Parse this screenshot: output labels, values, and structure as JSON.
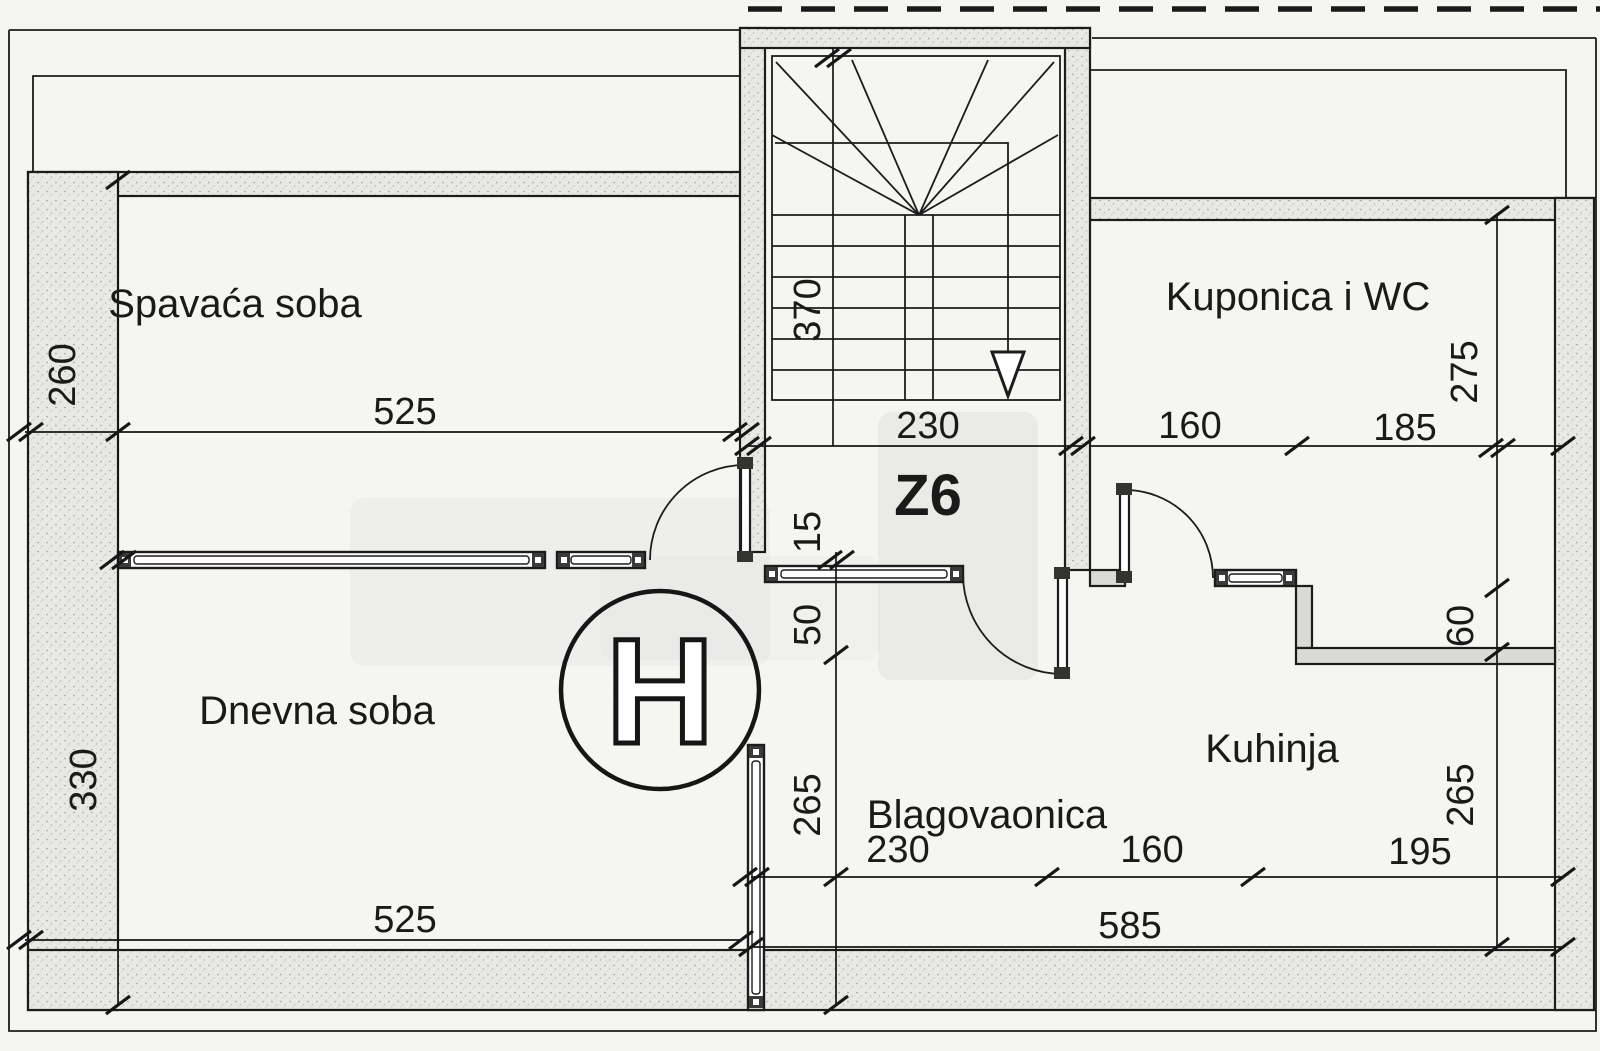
{
  "drawing": {
    "type": "apartment floor plan",
    "colors": {
      "ink": "#1a1a1a",
      "paper": "#f5f5f2",
      "wall_fill": "#e8e8e4"
    }
  },
  "rooms": {
    "bedroom": "Spavaća soba",
    "bathroom": "Kuponica i WC",
    "living": "Dnevna soba",
    "kitchen": "Kuhinja",
    "dining": "Blagovaonica",
    "hall_code": "Z6"
  },
  "stamp": {
    "letter": "H"
  },
  "dims": {
    "bedroom_depth": "260",
    "bedroom_width": "525",
    "stair_run": "370",
    "stair_width": "230",
    "bath_seg_left": "160",
    "bath_seg_right": "185",
    "bath_depth": "275",
    "wall_thickness": "15",
    "hall_offset": "50",
    "living_depth": "330",
    "living_width": "525",
    "dining_seg": "230",
    "kitchen_seg": "160",
    "kitchen_right_seg": "195",
    "bottom_total": "585",
    "dining_depth": "265",
    "kitchen_depth": "265",
    "kitchen_notch": "60"
  }
}
